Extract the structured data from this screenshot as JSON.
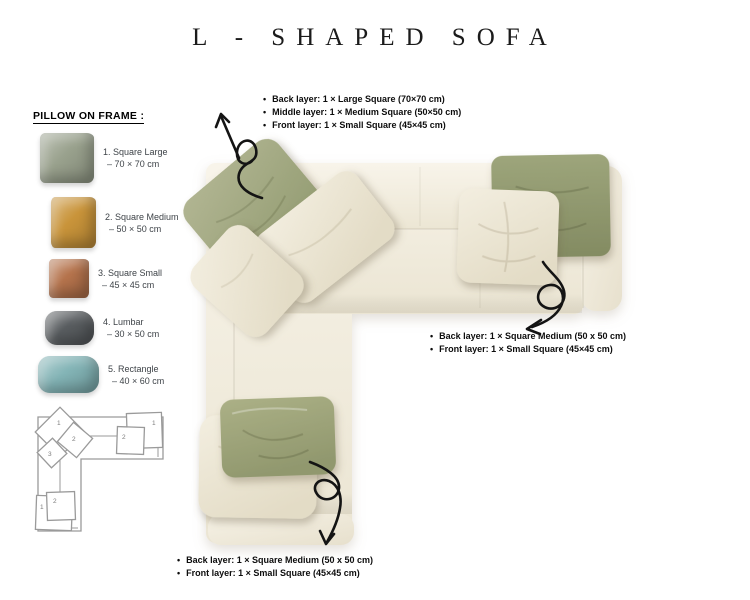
{
  "title": "L - SHAPED SOFA",
  "sidebar": {
    "header": "PILLOW ON FRAME :",
    "items": [
      {
        "label": "1. Square Large",
        "size": "– 70 × 70 cm",
        "color": "#99a18d"
      },
      {
        "label": "2. Square Medium",
        "size": "– 50 × 50 cm",
        "color": "#c9943a"
      },
      {
        "label": "3. Square Small",
        "size": "– 45 × 45 cm",
        "color": "#b5734c"
      },
      {
        "label": "4. Lumbar",
        "size": "– 30 × 50 cm",
        "color": "#595d60"
      },
      {
        "label": "5. Rectangle",
        "size": "– 40 × 60 cm",
        "color": "#83b4b6"
      }
    ]
  },
  "schematic": {
    "corner_labels": [
      "1",
      "2",
      "3"
    ],
    "right_labels": [
      "1",
      "2"
    ],
    "bottom_labels": [
      "1",
      "2"
    ]
  },
  "annotations": {
    "corner": {
      "items": [
        "Back layer: 1 × Large Square (70×70 cm)",
        "Middle layer: 1 × Medium Square (50×50 cm)",
        "Front layer: 1 × Small Square (45×45 cm)"
      ]
    },
    "right": {
      "items": [
        "Back layer: 1 × Square Medium (50 x 50 cm)",
        "Front layer: 1 × Small Square (45×45 cm)"
      ]
    },
    "bottom": {
      "items": [
        "Back layer: 1 × Square Medium (50 x 50 cm)",
        "Front layer: 1 × Small Square (45×45 cm)"
      ]
    }
  },
  "palette": {
    "sofa_cream": "#f2eee1",
    "pillow_cream": "#ece6d6",
    "pillow_green_light": "#a9ae8a",
    "pillow_green_dark": "#8f9674",
    "arrow_black": "#141414",
    "schematic_gray": "#9a9a9a"
  }
}
